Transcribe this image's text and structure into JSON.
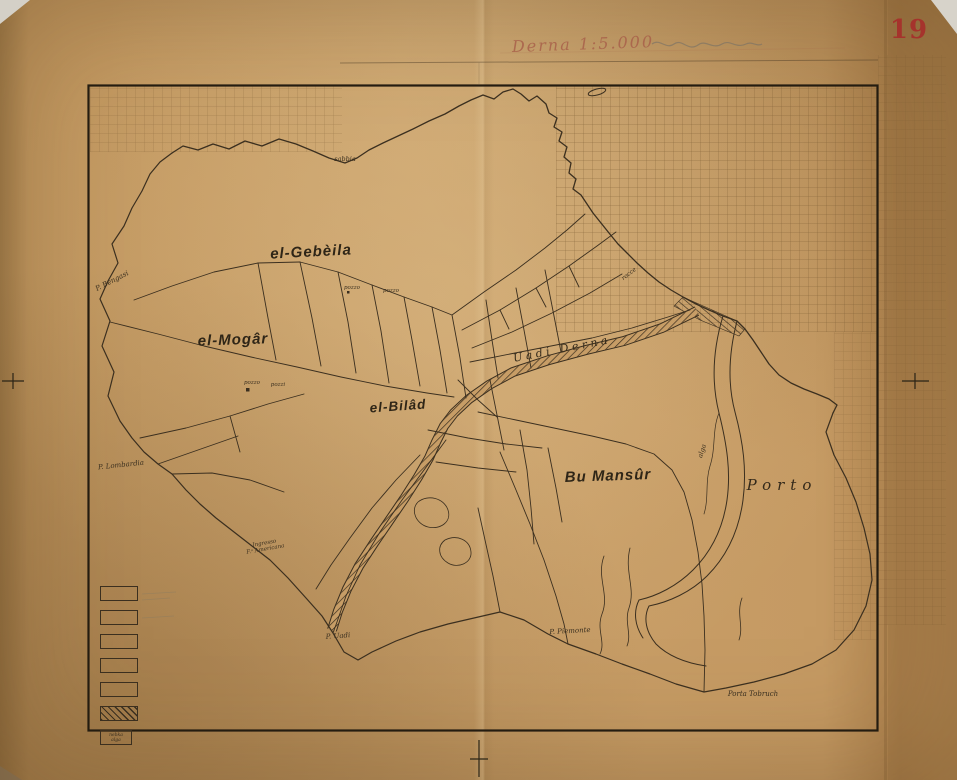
{
  "document": {
    "sheet_number": "19",
    "handwritten_title": "Derna 1:5.000"
  },
  "map_labels": {
    "district_gebeila": "el-Gebèila",
    "district_mogar": "el-Mogâr",
    "district_bilad": "el-Bilâd",
    "district_bumansur": "Bu Mansûr",
    "porto": "Porto",
    "uadi_derna": "Uadi Derna",
    "p_bengasi": "P. Bengasi",
    "p_lombardia": "P. Lombardia",
    "ingresso_line1": "Ingresso",
    "ingresso_line2": "F.ᵃ Americana",
    "p_uadi": "P. Uadi",
    "p_piemonte": "P. Piemonte",
    "porta_tobruch": "Porta Tobruch",
    "sabbia": "sabbia",
    "rocce": "rocce",
    "alga": "alga",
    "pozzo_1": "pozzo",
    "pozzo_2": "pozzo",
    "pozzo_3": "pozzo",
    "pozzi": "pozzi"
  },
  "legend": {
    "note_line1": "nebka",
    "note_line2": "alga"
  },
  "colors": {
    "paper": "#c69c65",
    "ink": "#3b2f1f",
    "stamp_red": "#a5332c",
    "handwriting_red": "#a8604a"
  }
}
